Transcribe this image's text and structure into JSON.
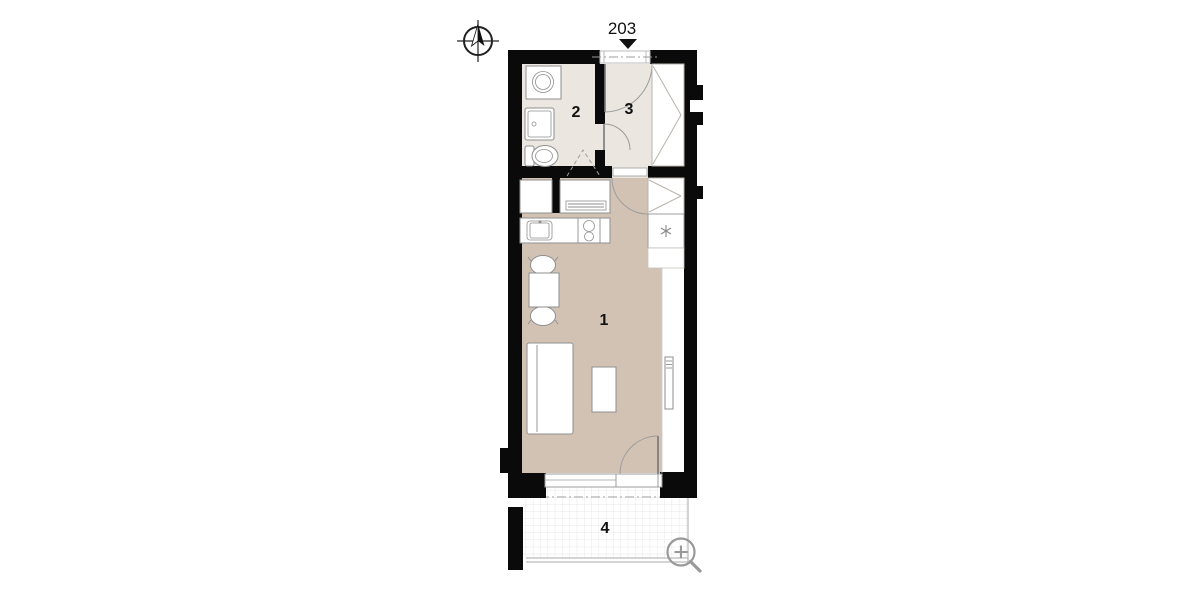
{
  "plan": {
    "unit_label": "203",
    "rooms": [
      {
        "id": "room-1",
        "label": "1"
      },
      {
        "id": "room-2",
        "label": "2"
      },
      {
        "id": "room-3",
        "label": "3"
      },
      {
        "id": "room-4",
        "label": "4"
      }
    ],
    "icons": [
      "north-arrow-icon",
      "entrance-marker-icon",
      "zoom-in-icon",
      "snowflake-icon"
    ],
    "fixtures": [
      "washing-machine",
      "bathroom-sink",
      "toilet",
      "wardrobe",
      "fridge",
      "kitchen-cabinet",
      "kitchen-counter",
      "kitchen-sink",
      "cooktop",
      "dining-table",
      "chair",
      "sofa-bed",
      "coffee-table",
      "radiator",
      "balcony-door",
      "entrance-door"
    ],
    "colors": {
      "wall": "#0a0a0a",
      "floor_warm": "#d2c2b4",
      "floor_light": "#ebe7e0",
      "fixture_stroke": "#8f8f8f",
      "wardrobe_line": "#b9b4ac",
      "grid_line": "#e0e0e0",
      "guide_line": "#9c9c9c",
      "label_ink": "#111111",
      "zoom_icon": "#999999"
    }
  }
}
